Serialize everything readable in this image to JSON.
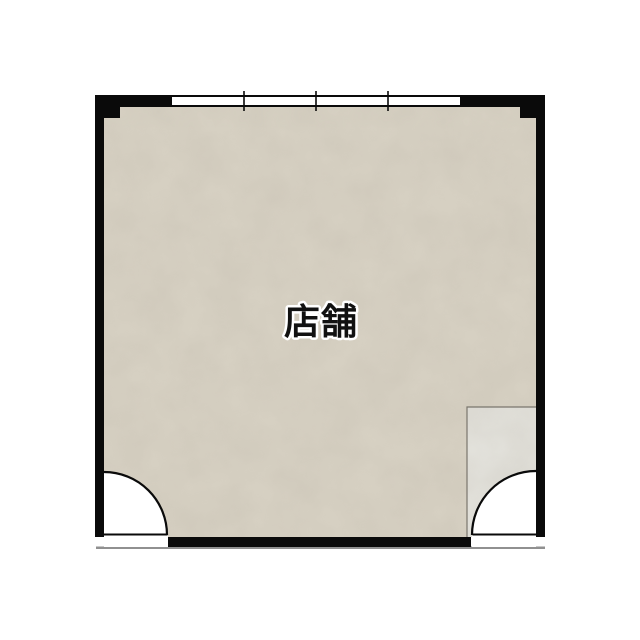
{
  "plan": {
    "room_label": "店舗",
    "window_pane_count": 4
  },
  "colors": {
    "background": "#ffffff",
    "wall": "#0a0a0a",
    "floor_base": "#d8d2c4",
    "floor_secondary": "#e4e3dd",
    "secondary_border": "#7a766d",
    "door_swing": "#ffffff",
    "window_glass": "#ffffff",
    "ground_shadow": "#909090",
    "label_fill": "#111111",
    "label_outline": "#ffffff"
  }
}
